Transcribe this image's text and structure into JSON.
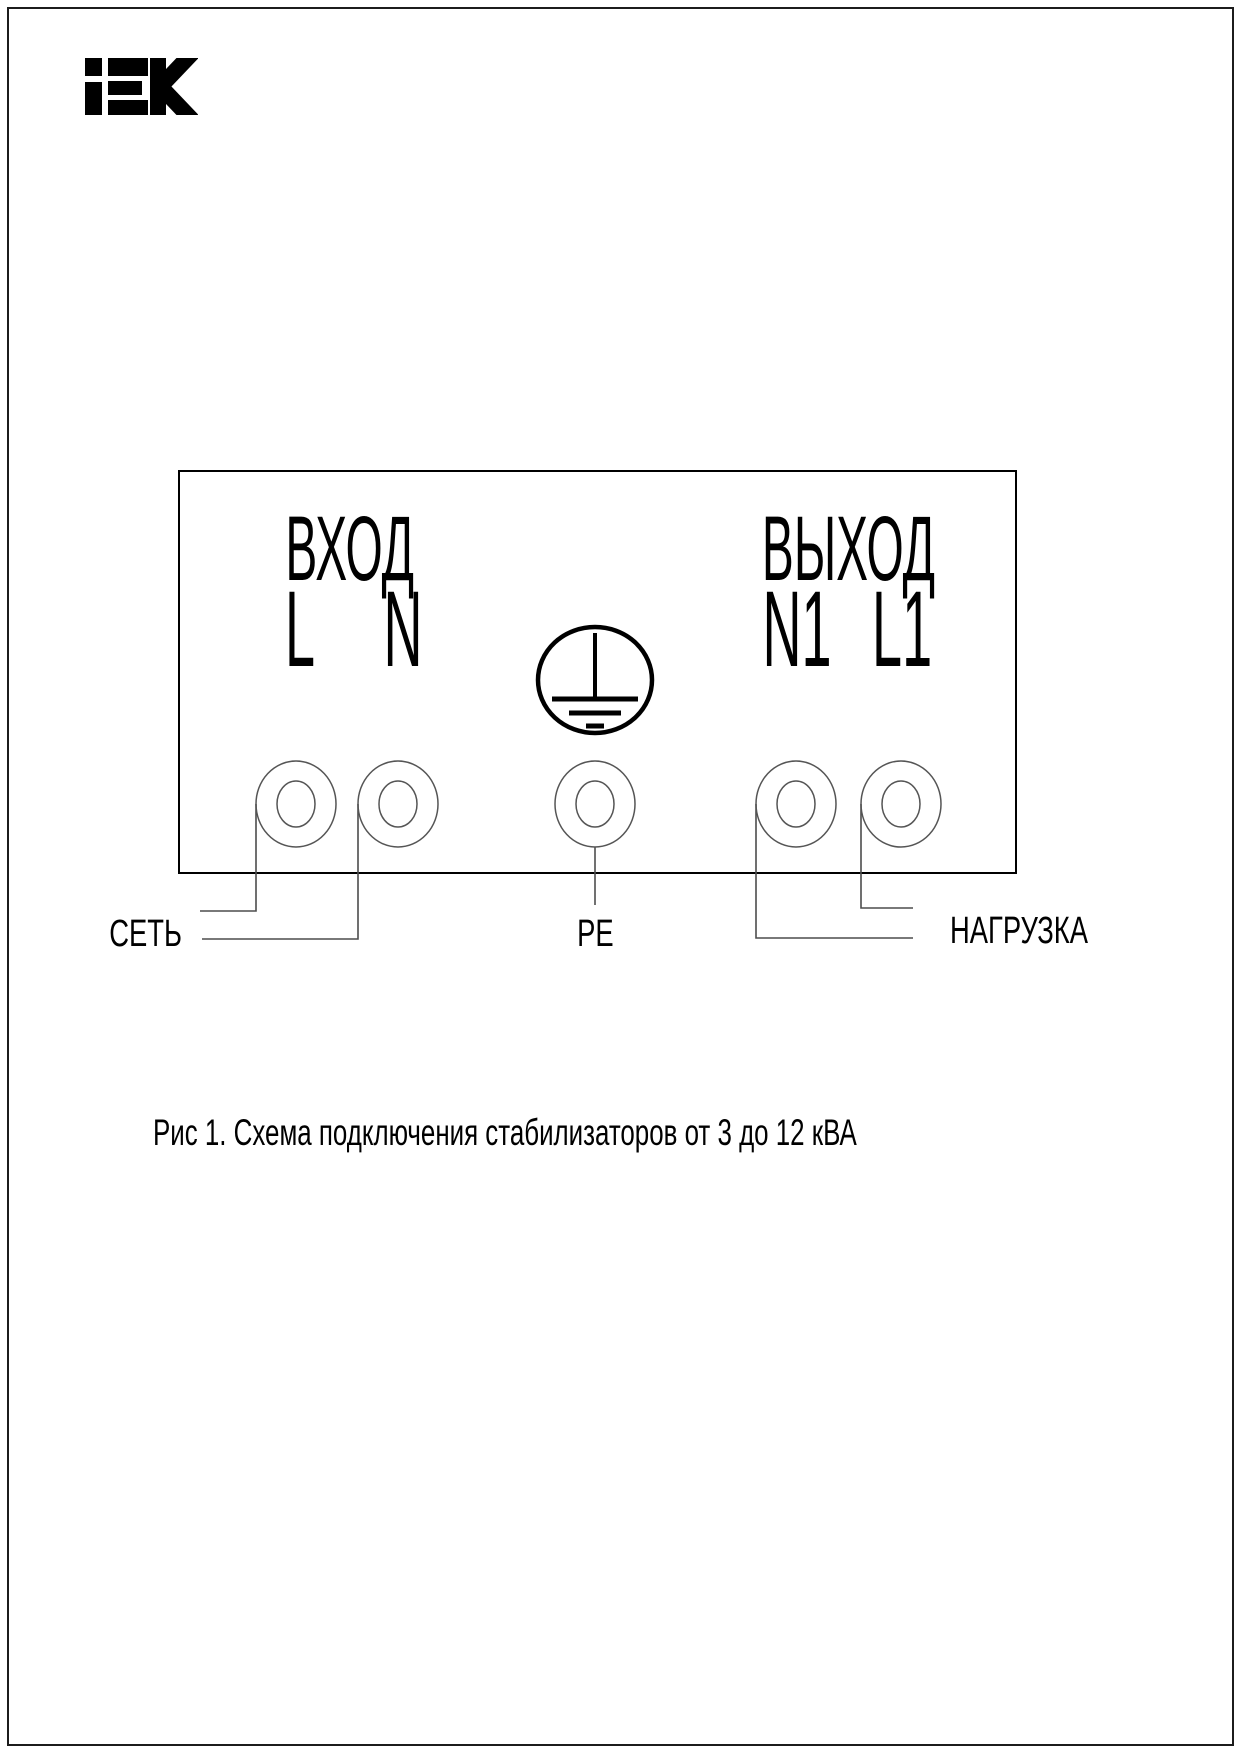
{
  "header": {
    "logo_text": "iEK"
  },
  "diagram": {
    "section_labels": {
      "input": "ВХОД",
      "output": "ВЫХОД"
    },
    "terminal_labels": {
      "l": "L",
      "n": "N",
      "n1": "N1",
      "l1": "L1"
    },
    "ground_icon": "protective-earth-symbol",
    "wire_labels": {
      "mains": "СЕТЬ",
      "pe": "PE",
      "load": "НАГРУЗКА"
    }
  },
  "caption": {
    "text": "Рис 1. Схема подключения стабилизаторов от 3 до 12 кВА"
  },
  "colors": {
    "ink": "#000000",
    "wire": "#4d4d4d",
    "terminal_stroke": "#555555",
    "background": "#ffffff"
  }
}
